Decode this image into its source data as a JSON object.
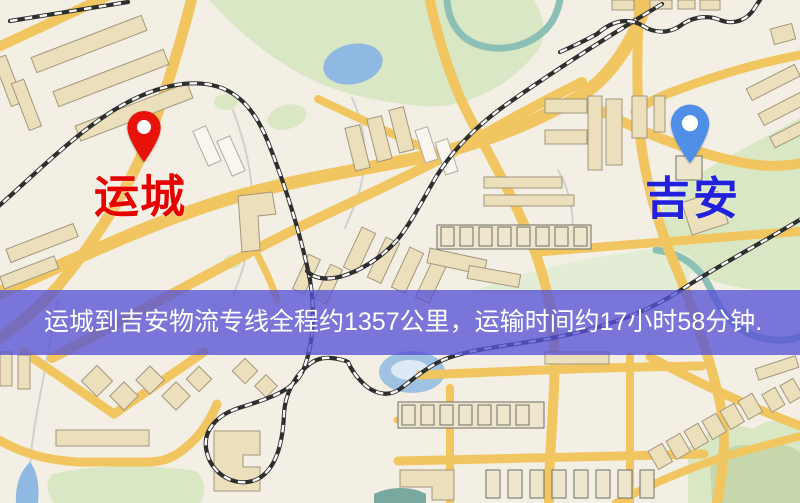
{
  "markers": {
    "origin": {
      "label": "运城",
      "pin_color": "#e8130b",
      "label_color": "#e60000"
    },
    "destination": {
      "label": "吉安",
      "pin_color": "#4f8fe8",
      "label_color": "#2020dd"
    }
  },
  "banner": {
    "text": "运城到吉安物流专线全程约1357公里，运输时间约17小时58分钟.",
    "distance_km": "1357",
    "duration_text": "17小时58分钟",
    "background_color": "#5652d6",
    "text_color": "#ffffff"
  },
  "map_colors": {
    "background": "#f3efe4",
    "road": "#f1c660",
    "building_fill": "#ebdfbc",
    "building_stroke": "#a3967c",
    "park": "#d9e7c4",
    "water": "#8fb9e2",
    "railway": "#2e2e2e"
  }
}
